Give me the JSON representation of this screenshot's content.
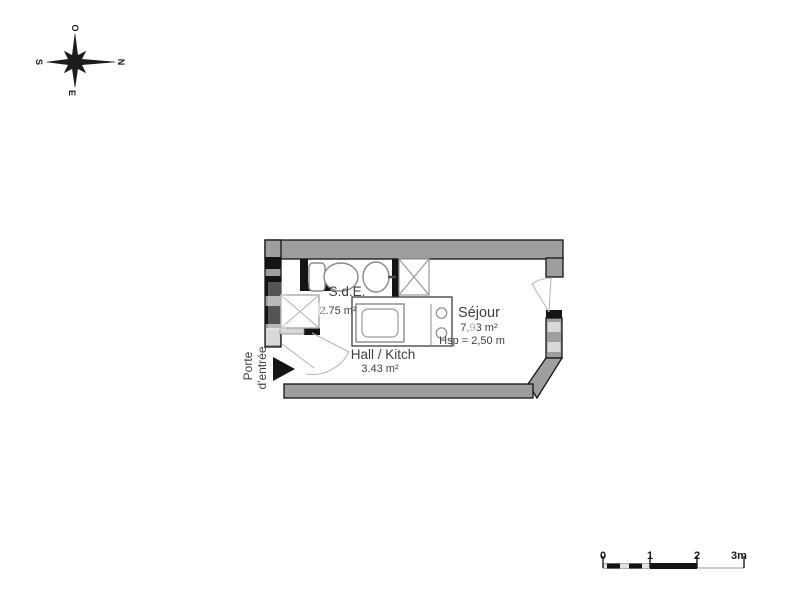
{
  "compass": {
    "west": "O",
    "north": "N",
    "south": "S",
    "east": "E"
  },
  "floor_plan": {
    "rooms": [
      {
        "name": "S.d.E.",
        "area": "2.75 m²"
      },
      {
        "name": "Hall / Kitch",
        "area": "3.43 m²"
      },
      {
        "name": "Séjour",
        "area": "7,93 m²",
        "ceiling_height": "Hsp = 2,50 m"
      }
    ],
    "entrance": {
      "label_line1": "Porte",
      "label_line2": "d'entrée"
    }
  },
  "scale_bar": {
    "labels": [
      "0",
      "1",
      "2",
      "3m"
    ]
  },
  "colors": {
    "wall_fill": "#9e9e9e",
    "wall_dark": "#141414",
    "wall_light": "#d8d8d8",
    "fixture_stroke": "#8a8a8a",
    "door_swing": "#b5b5b5",
    "text": "#3f3f3f"
  }
}
